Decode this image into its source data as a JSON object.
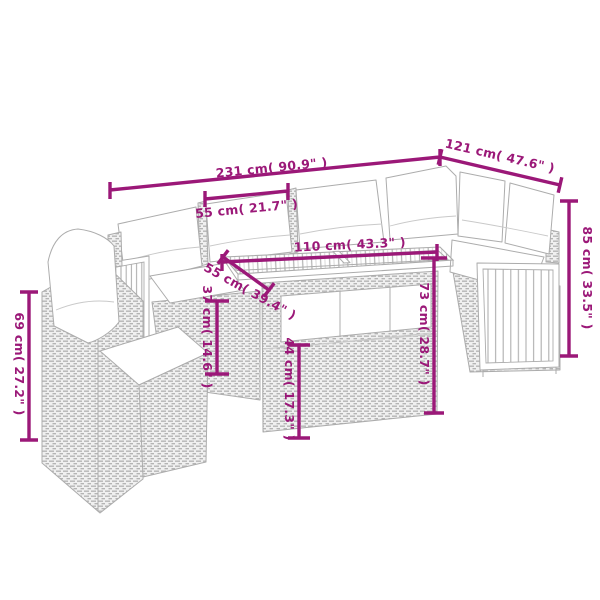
{
  "diagram": {
    "accent_color": "#9B1878",
    "sketch_color": "#ACACAC",
    "product": "rattan corner sofa set with slatted wood table and cushions",
    "dimensions": {
      "total_width": "231 cm( 90.9\" )",
      "right_section_width": "121 cm( 47.6\" )",
      "seat_width": "55 cm( 21.7\" )",
      "table_length": "110 cm( 43.3\" )",
      "table_depth": "55 cm( 39.4\" )",
      "back_height": "85 cm( 33.5\" )",
      "chair_height": "69 cm( 27.2\" )",
      "table_height": "73 cm( 28.7\" )",
      "table_base_height": "44 cm( 17.3\" )",
      "seat_height": "37 cm( 14.6\" )"
    }
  }
}
